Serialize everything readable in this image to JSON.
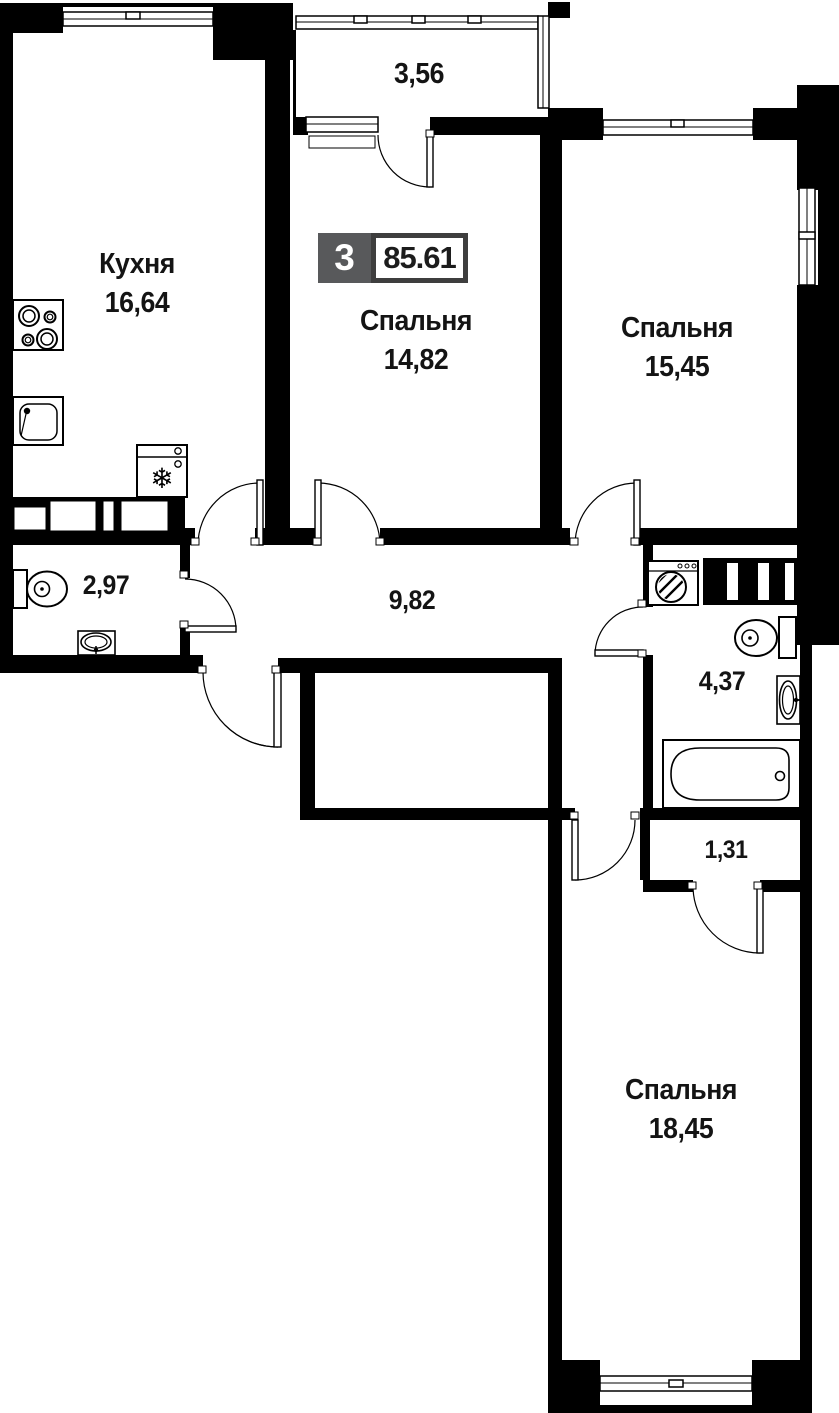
{
  "plan": {
    "badge": {
      "room_count": "3",
      "total_area": "85.61"
    },
    "rooms": [
      {
        "key": "balcony",
        "name": "",
        "area": "3,56"
      },
      {
        "key": "kitchen",
        "name": "Кухня",
        "area": "16,64"
      },
      {
        "key": "bedroom-1",
        "name": "Спальня",
        "area": "14,82"
      },
      {
        "key": "bedroom-2",
        "name": "Спальня",
        "area": "15,45"
      },
      {
        "key": "bathroom-1",
        "name": "",
        "area": "2,97"
      },
      {
        "key": "hallway",
        "name": "",
        "area": "9,82"
      },
      {
        "key": "bathroom-2",
        "name": "",
        "area": "4,37"
      },
      {
        "key": "vestibule",
        "name": "",
        "area": "1,31"
      },
      {
        "key": "bedroom-3",
        "name": "Спальня",
        "area": "18,45"
      }
    ],
    "icons": {
      "fridge_glyph": "❄",
      "fixtures": [
        "stove-icon",
        "kitchen-sink-icon",
        "fridge-icon",
        "toilet-icon",
        "washbasin-icon",
        "washing-machine-icon",
        "bathtub-icon",
        "vent-shaft-icon",
        "door-swing-icon",
        "window-icon"
      ]
    },
    "colors": {
      "wall": "#000000",
      "text": "#141414",
      "badge_gray": "#58595b",
      "badge_border": "#3e3e3e",
      "background": "#ffffff"
    }
  }
}
